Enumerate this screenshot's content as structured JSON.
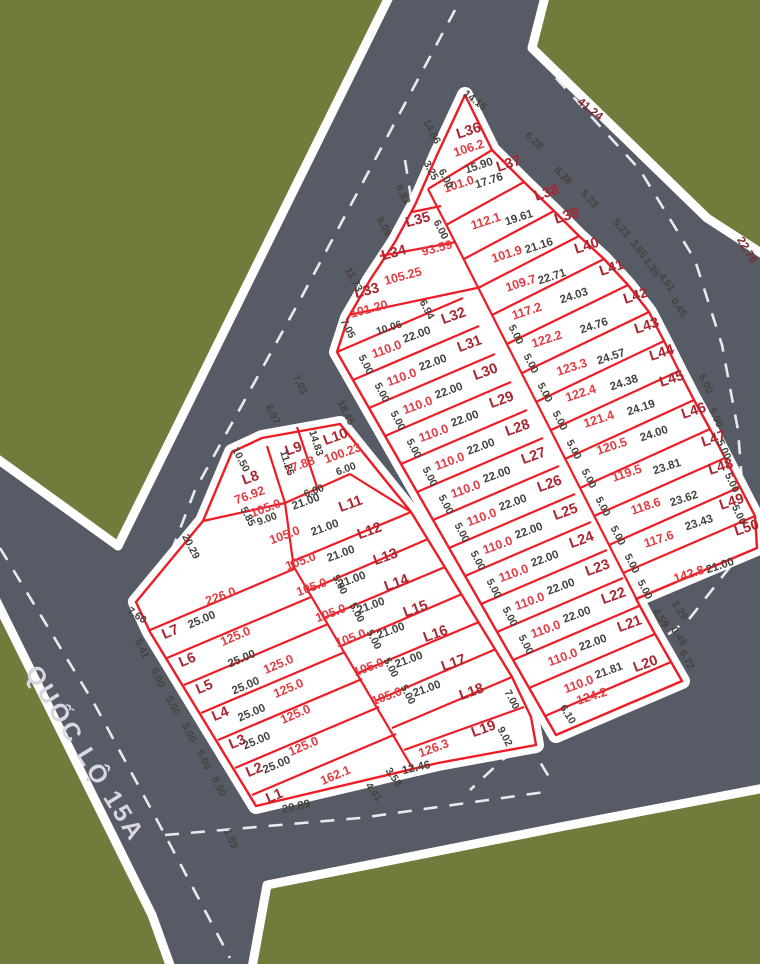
{
  "map_title": "Land subdivision plan",
  "road_name": "QUỐC LỘ 15A",
  "colors": {
    "green": "#6F7C3B",
    "road": "#575B66",
    "white": "#FFFFFF",
    "lot_line": "#EE1C25",
    "lot_label": "#A92731",
    "lot_area": "#E23B41",
    "dim_text": "#46423C",
    "road_dim_text": "#7D2A2D",
    "centerline": "#E9E9ED",
    "road_name_text": "#D9D7E1"
  },
  "lots": [
    {
      "label": "L1",
      "area": "162.1",
      "len": "20.89",
      "lp": [
        276,
        800
      ],
      "ap": [
        337,
        779
      ],
      "lnp": [
        297,
        810
      ],
      "r": -23,
      "lnr": -13
    },
    {
      "label": "L2",
      "len": "25.00",
      "lp": [
        256,
        774
      ],
      "lnp": [
        278,
        768
      ],
      "r": -23
    },
    {
      "label": "L3",
      "area": "125.0",
      "len": "25.00",
      "lp": [
        239,
        746
      ],
      "ap": [
        305,
        750
      ],
      "lnp": [
        258,
        744
      ],
      "r": -23
    },
    {
      "label": "L4",
      "area": "125.0",
      "len": "25.00",
      "lp": [
        222,
        718
      ],
      "ap": [
        297,
        718
      ],
      "lnp": [
        253,
        716
      ],
      "r": -23
    },
    {
      "label": "L5",
      "area": "125.0",
      "len": "25.00",
      "lp": [
        206,
        691
      ],
      "ap": [
        290,
        692
      ],
      "lnp": [
        247,
        689
      ],
      "r": -23
    },
    {
      "label": "L6",
      "area": "125.0",
      "len": "25.00",
      "lp": [
        189,
        664
      ],
      "ap": [
        280,
        668
      ],
      "lnp": [
        243,
        662
      ],
      "r": -23
    },
    {
      "label": "L7",
      "area": "125.0",
      "len": "25.00",
      "lp": [
        172,
        636
      ],
      "ap": [
        237,
        640
      ],
      "lnp": [
        203,
        623
      ],
      "r": -23
    },
    {
      "label": "L8",
      "area": "76.92",
      "lp": [
        252,
        482
      ],
      "ap": [
        251,
        499
      ],
      "r": -20
    },
    {
      "label": "L9",
      "area": "77.88",
      "lp": [
        295,
        453
      ],
      "ap": [
        301,
        469
      ],
      "r": -20
    },
    {
      "label": "L10",
      "area": "100.23",
      "lp": [
        337,
        441
      ],
      "ap": [
        344,
        457
      ],
      "r": -20
    },
    {
      "label": "L11",
      "area": "105.0",
      "len": "21.00",
      "lp": [
        352,
        508
      ],
      "ap": [
        267,
        512
      ],
      "lnp": [
        307,
        505
      ],
      "r": -20
    },
    {
      "label": "L12",
      "area": "105.0",
      "len": "21.00",
      "lp": [
        371,
        535
      ],
      "ap": [
        286,
        539
      ],
      "lnp": [
        326,
        531
      ],
      "r": -20
    },
    {
      "label": "L13",
      "area": "105.0",
      "len": "21.00",
      "lp": [
        387,
        561
      ],
      "ap": [
        302,
        565
      ],
      "lnp": [
        342,
        557
      ],
      "r": -20
    },
    {
      "label": "L14",
      "area": "105.0",
      "len": "21.00",
      "lp": [
        398,
        587
      ],
      "ap": [
        313,
        591
      ],
      "lnp": [
        353,
        583
      ],
      "r": -20
    },
    {
      "label": "L15",
      "area": "105.0",
      "len": "21.00",
      "lp": [
        417,
        613
      ],
      "ap": [
        332,
        617
      ],
      "lnp": [
        372,
        609
      ],
      "r": -20
    },
    {
      "label": "L16",
      "area": "105.0",
      "len": "21.00",
      "lp": [
        437,
        638
      ],
      "ap": [
        352,
        642
      ],
      "lnp": [
        392,
        634
      ],
      "r": -20
    },
    {
      "label": "L17",
      "area": "105.0",
      "len": "21.00",
      "lp": [
        455,
        667
      ],
      "ap": [
        370,
        671
      ],
      "lnp": [
        410,
        663
      ],
      "r": -20
    },
    {
      "label": "L18",
      "area": "105.0",
      "len": "21.00",
      "lp": [
        473,
        696
      ],
      "ap": [
        388,
        700
      ],
      "lnp": [
        428,
        692
      ],
      "r": -20
    },
    {
      "label": "L19",
      "area": "126.3",
      "len": "12.46",
      "lp": [
        485,
        733
      ],
      "ap": [
        435,
        752
      ],
      "lnp": [
        417,
        771
      ],
      "r": -20,
      "lnr": -13
    },
    {
      "label": "L20",
      "area": "110.0",
      "len": "21.81",
      "lp": [
        647,
        668
      ],
      "ap": [
        580,
        688
      ],
      "lnp": [
        610,
        674
      ],
      "r": -20
    },
    {
      "label": "L21",
      "area": "110.0",
      "len": "22.00",
      "lp": [
        631,
        628
      ],
      "ap": [
        564,
        661
      ],
      "lnp": [
        594,
        646
      ],
      "r": -20
    },
    {
      "label": "L22",
      "area": "110.0",
      "len": "22.00",
      "lp": [
        615,
        600
      ],
      "ap": [
        547,
        633
      ],
      "lnp": [
        578,
        618
      ],
      "r": -20
    },
    {
      "label": "L23",
      "area": "110.0",
      "len": "22.00",
      "lp": [
        599,
        572
      ],
      "ap": [
        531,
        605
      ],
      "lnp": [
        562,
        590
      ],
      "r": -20
    },
    {
      "label": "L24",
      "area": "110.0",
      "len": "22.00",
      "lp": [
        583,
        544
      ],
      "ap": [
        515,
        577
      ],
      "lnp": [
        546,
        562
      ],
      "r": -20
    },
    {
      "label": "L25",
      "area": "110.0",
      "len": "22.00",
      "lp": [
        567,
        516
      ],
      "ap": [
        499,
        549
      ],
      "lnp": [
        530,
        534
      ],
      "r": -20
    },
    {
      "label": "L26",
      "area": "110.0",
      "len": "22.00",
      "lp": [
        551,
        488
      ],
      "ap": [
        483,
        521
      ],
      "lnp": [
        514,
        506
      ],
      "r": -20
    },
    {
      "label": "L27",
      "area": "110.0",
      "len": "22.00",
      "lp": [
        535,
        460
      ],
      "ap": [
        467,
        493
      ],
      "lnp": [
        498,
        478
      ],
      "r": -20
    },
    {
      "label": "L28",
      "area": "110.0",
      "len": "22.00",
      "lp": [
        519,
        432
      ],
      "ap": [
        451,
        465
      ],
      "lnp": [
        482,
        450
      ],
      "r": -20
    },
    {
      "label": "L29",
      "area": "110.0",
      "len": "22.00",
      "lp": [
        503,
        404
      ],
      "ap": [
        435,
        437
      ],
      "lnp": [
        466,
        422
      ],
      "r": -20
    },
    {
      "label": "L30",
      "area": "110.0",
      "len": "22.00",
      "lp": [
        487,
        376
      ],
      "ap": [
        419,
        409
      ],
      "lnp": [
        450,
        394
      ],
      "r": -20
    },
    {
      "label": "L31",
      "area": "110.0",
      "len": "22.00",
      "lp": [
        471,
        348
      ],
      "ap": [
        403,
        381
      ],
      "lnp": [
        434,
        366
      ],
      "r": -20
    },
    {
      "label": "L32",
      "area": "110.0",
      "len": "22.00",
      "lp": [
        455,
        320
      ],
      "ap": [
        388,
        353
      ],
      "lnp": [
        418,
        338
      ],
      "r": -20
    },
    {
      "label": "L33",
      "area": "101.20",
      "lp": [
        368,
        295
      ],
      "ap": [
        370,
        313
      ],
      "r": -15
    },
    {
      "label": "L34",
      "area": "105.25",
      "lp": [
        395,
        257
      ],
      "ap": [
        404,
        280
      ],
      "r": -15
    },
    {
      "label": "L35",
      "area": "93.59",
      "lp": [
        419,
        224
      ],
      "ap": [
        438,
        252
      ],
      "r": -15
    },
    {
      "label": "L36",
      "area": "106.2",
      "len": "15.90",
      "lp": [
        470,
        135
      ],
      "ap": [
        470,
        152
      ],
      "lnp": [
        480,
        169
      ],
      "r": -18
    },
    {
      "label": "L37",
      "area": "101.0",
      "len": "17.76",
      "lp": [
        510,
        168
      ],
      "ap": [
        460,
        188
      ],
      "lnp": [
        490,
        184
      ],
      "r": -18
    },
    {
      "label": "L38",
      "area": "112.1",
      "len": "19.61",
      "lp": [
        548,
        197
      ],
      "ap": [
        487,
        225
      ],
      "lnp": [
        520,
        221
      ],
      "r": -18
    },
    {
      "label": "L39",
      "area": "101.9",
      "len": "21.16",
      "lp": [
        568,
        220
      ],
      "ap": [
        508,
        258
      ],
      "lnp": [
        540,
        249
      ],
      "r": -18
    },
    {
      "label": "L40",
      "area": "109.7",
      "len": "22.71",
      "lp": [
        588,
        250
      ],
      "ap": [
        522,
        287
      ],
      "lnp": [
        553,
        280
      ],
      "r": -18
    },
    {
      "label": "L41",
      "area": "117.2",
      "len": "24.03",
      "lp": [
        613,
        272
      ],
      "ap": [
        528,
        315
      ],
      "lnp": [
        575,
        299
      ],
      "r": -18
    },
    {
      "label": "L42",
      "area": "122.2",
      "len": "24.76",
      "lp": [
        637,
        300
      ],
      "ap": [
        548,
        343
      ],
      "lnp": [
        595,
        329
      ],
      "r": -18
    },
    {
      "label": "L43",
      "area": "123.3",
      "len": "24.57",
      "lp": [
        648,
        330
      ],
      "ap": [
        573,
        371
      ],
      "lnp": [
        612,
        360
      ],
      "r": -18
    },
    {
      "label": "L44",
      "area": "122.4",
      "len": "24.38",
      "lp": [
        663,
        357
      ],
      "ap": [
        582,
        397
      ],
      "lnp": [
        625,
        386
      ],
      "r": -18
    },
    {
      "label": "L45",
      "area": "121.4",
      "len": "24.19",
      "lp": [
        673,
        383
      ],
      "ap": [
        600,
        423
      ],
      "lnp": [
        642,
        411
      ],
      "r": -18
    },
    {
      "label": "L46",
      "area": "120.5",
      "len": "24.00",
      "lp": [
        695,
        415
      ],
      "ap": [
        613,
        450
      ],
      "lnp": [
        655,
        437
      ],
      "r": -18
    },
    {
      "label": "L47",
      "area": "119.5",
      "len": "23.81",
      "lp": [
        715,
        443
      ],
      "ap": [
        628,
        477
      ],
      "lnp": [
        668,
        470
      ],
      "r": -18
    },
    {
      "label": "L48",
      "area": "118.6",
      "len": "23.62",
      "lp": [
        722,
        471
      ],
      "ap": [
        647,
        510
      ],
      "lnp": [
        685,
        502
      ],
      "r": -18
    },
    {
      "label": "L49",
      "area": "117.6",
      "len": "23.43",
      "lp": [
        733,
        506
      ],
      "ap": [
        660,
        543
      ],
      "lnp": [
        700,
        526
      ],
      "r": -18
    },
    {
      "label": "L50",
      "area": "142.8",
      "len": "21.00",
      "lp": [
        748,
        532
      ],
      "ap": [
        690,
        578
      ],
      "lnp": [
        721,
        569
      ],
      "r": -18
    }
  ],
  "extra_areas": [
    {
      "t": "226.0",
      "x": 222,
      "y": 600,
      "r": -20
    },
    {
      "t": "124.2",
      "x": 593,
      "y": 700,
      "r": -18
    }
  ],
  "dims": [
    {
      "t": "14.15",
      "x": 473,
      "y": 103,
      "r": 38
    },
    {
      "t": "6.28",
      "x": 532,
      "y": 143,
      "r": 42
    },
    {
      "t": "6.28",
      "x": 561,
      "y": 178,
      "r": 45
    },
    {
      "t": "5.23",
      "x": 587,
      "y": 201,
      "r": 47
    },
    {
      "t": "5.23",
      "x": 619,
      "y": 230,
      "r": 50
    },
    {
      "t": "3.65",
      "x": 636,
      "y": 251,
      "r": 52
    },
    {
      "t": "1.35",
      "x": 649,
      "y": 269,
      "r": 55
    },
    {
      "t": "4.61",
      "x": 664,
      "y": 284,
      "r": 55
    },
    {
      "t": "0.45",
      "x": 676,
      "y": 309,
      "r": 58
    },
    {
      "t": "5.00",
      "x": 703,
      "y": 385,
      "r": 65
    },
    {
      "t": "5.00",
      "x": 713,
      "y": 419,
      "r": 65
    },
    {
      "t": "5.00",
      "x": 721,
      "y": 451,
      "r": 65
    },
    {
      "t": "5.00",
      "x": 729,
      "y": 484,
      "r": 65
    },
    {
      "t": "5.00",
      "x": 736,
      "y": 516,
      "r": 65
    },
    {
      "t": "14.66",
      "x": 429,
      "y": 133,
      "r": 62
    },
    {
      "t": "3.25",
      "x": 428,
      "y": 172,
      "r": 62
    },
    {
      "t": "6.00",
      "x": 443,
      "y": 180,
      "r": 62
    },
    {
      "t": "5.83",
      "x": 400,
      "y": 196,
      "r": 62
    },
    {
      "t": "8.09",
      "x": 381,
      "y": 228,
      "r": 62
    },
    {
      "t": "11.73",
      "x": 351,
      "y": 281,
      "r": 62
    },
    {
      "t": "6.00",
      "x": 438,
      "y": 231,
      "r": 62
    },
    {
      "t": "7.05",
      "x": 345,
      "y": 330,
      "r": 62
    },
    {
      "t": "10.06",
      "x": 390,
      "y": 331,
      "r": -18
    },
    {
      "t": "6.94",
      "x": 424,
      "y": 311,
      "r": 62
    },
    {
      "t": "4.59",
      "x": 658,
      "y": 620,
      "r": 55
    },
    {
      "t": "1.29",
      "x": 677,
      "y": 612,
      "r": 58
    },
    {
      "t": "0.48",
      "x": 676,
      "y": 638,
      "r": 58
    },
    {
      "t": "6.72",
      "x": 684,
      "y": 661,
      "r": 62
    },
    {
      "t": "6.10",
      "x": 565,
      "y": 716,
      "r": 58
    },
    {
      "t": "20.29",
      "x": 188,
      "y": 548,
      "r": 62
    },
    {
      "t": "10.50",
      "x": 238,
      "y": 461,
      "r": 62
    },
    {
      "t": "7.60",
      "x": 135,
      "y": 618,
      "r": 35
    },
    {
      "t": "5.41",
      "x": 139,
      "y": 650,
      "r": 65
    },
    {
      "t": "5.00",
      "x": 155,
      "y": 679,
      "r": 65
    },
    {
      "t": "5.00",
      "x": 170,
      "y": 707,
      "r": 65
    },
    {
      "t": "5.00",
      "x": 186,
      "y": 734,
      "r": 65
    },
    {
      "t": "5.00",
      "x": 201,
      "y": 761,
      "r": 65
    },
    {
      "t": "5.00",
      "x": 216,
      "y": 788,
      "r": 65
    },
    {
      "t": "1.59",
      "x": 228,
      "y": 840,
      "r": 65
    },
    {
      "t": "6.97",
      "x": 270,
      "y": 416,
      "r": 62
    },
    {
      "t": "7.03",
      "x": 297,
      "y": 386,
      "r": 62
    },
    {
      "t": "18.45",
      "x": 343,
      "y": 414,
      "r": 64
    },
    {
      "t": "14.83",
      "x": 313,
      "y": 444,
      "r": 72
    },
    {
      "t": "11.25",
      "x": 284,
      "y": 464,
      "r": 72
    },
    {
      "t": "5.85",
      "x": 245,
      "y": 518,
      "r": 62
    },
    {
      "t": "9.00",
      "x": 268,
      "y": 522,
      "r": -20
    },
    {
      "t": "6.00",
      "x": 315,
      "y": 494,
      "r": -20
    },
    {
      "t": "6.00",
      "x": 347,
      "y": 472,
      "r": -20
    },
    {
      "t": "5.00",
      "x": 337,
      "y": 586,
      "r": 62
    },
    {
      "t": "5.00",
      "x": 354,
      "y": 614,
      "r": 62
    },
    {
      "t": "5.00",
      "x": 371,
      "y": 641,
      "r": 62
    },
    {
      "t": "5.00",
      "x": 388,
      "y": 669,
      "r": 62
    },
    {
      "t": "5.00",
      "x": 405,
      "y": 696,
      "r": 62
    },
    {
      "t": "7.00",
      "x": 509,
      "y": 701,
      "r": 62
    },
    {
      "t": "9.02",
      "x": 502,
      "y": 738,
      "r": 62
    },
    {
      "t": "4.41",
      "x": 371,
      "y": 794,
      "r": 55
    },
    {
      "t": "3.58",
      "x": 391,
      "y": 779,
      "r": 55
    },
    {
      "t": "5.00",
      "x": 363,
      "y": 366,
      "r": 62
    },
    {
      "t": "5.00",
      "x": 379,
      "y": 394,
      "r": 62
    },
    {
      "t": "5.00",
      "x": 395,
      "y": 422,
      "r": 62
    },
    {
      "t": "5.00",
      "x": 411,
      "y": 450,
      "r": 62
    },
    {
      "t": "5.00",
      "x": 427,
      "y": 478,
      "r": 62
    },
    {
      "t": "5.00",
      "x": 443,
      "y": 506,
      "r": 62
    },
    {
      "t": "5.00",
      "x": 459,
      "y": 534,
      "r": 62
    },
    {
      "t": "5.00",
      "x": 475,
      "y": 562,
      "r": 62
    },
    {
      "t": "5.00",
      "x": 491,
      "y": 590,
      "r": 62
    },
    {
      "t": "5.00",
      "x": 507,
      "y": 618,
      "r": 62
    },
    {
      "t": "5.00",
      "x": 523,
      "y": 646,
      "r": 62
    },
    {
      "t": "5.00",
      "x": 513,
      "y": 336,
      "r": 62
    },
    {
      "t": "5.00",
      "x": 528,
      "y": 365,
      "r": 62
    },
    {
      "t": "5.00",
      "x": 542,
      "y": 394,
      "r": 62
    },
    {
      "t": "5.00",
      "x": 557,
      "y": 422,
      "r": 62
    },
    {
      "t": "5.00",
      "x": 571,
      "y": 451,
      "r": 62
    },
    {
      "t": "5.00",
      "x": 586,
      "y": 480,
      "r": 62
    },
    {
      "t": "5.00",
      "x": 600,
      "y": 508,
      "r": 62
    },
    {
      "t": "5.00",
      "x": 615,
      "y": 537,
      "r": 62
    },
    {
      "t": "5.00",
      "x": 629,
      "y": 565,
      "r": 62
    },
    {
      "t": "5.00",
      "x": 642,
      "y": 591,
      "r": 62
    }
  ],
  "road_dims": [
    {
      "t": "41.24",
      "x": 588,
      "y": 112,
      "r": 38
    },
    {
      "t": "22.76",
      "x": 744,
      "y": 252,
      "r": 60
    }
  ]
}
